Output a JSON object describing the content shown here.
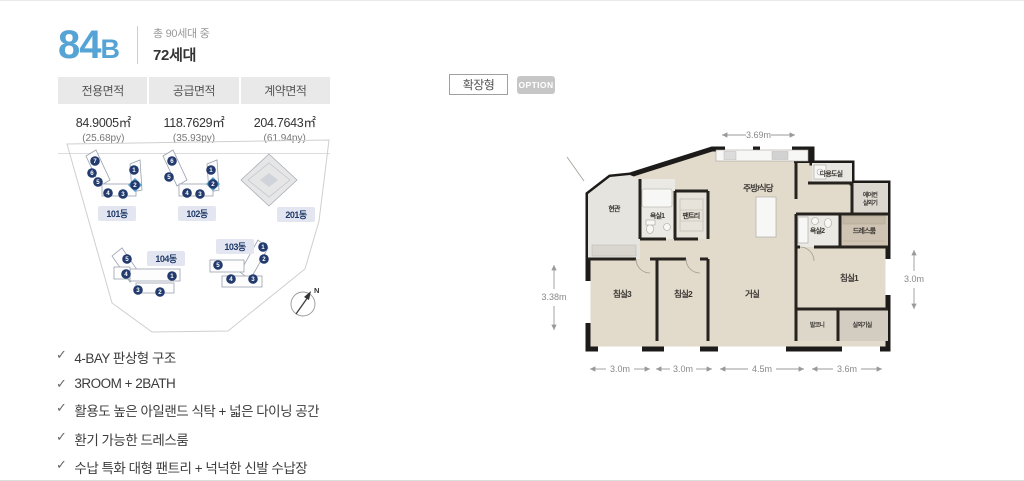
{
  "page": {
    "bg": "#ffffff",
    "border_color": "#e9e9e9"
  },
  "header": {
    "unit_number": "84",
    "unit_letter": "B",
    "accent_color": "#56a4d5",
    "total_text": "총 90세대 중",
    "count_text": "72세대"
  },
  "area_table": {
    "columns": [
      {
        "label": "전용면적",
        "area": "84.9005㎡",
        "py": "(25.68py)"
      },
      {
        "label": "공급면적",
        "area": "118.7629㎡",
        "py": "(35.93py)"
      },
      {
        "label": "계약면적",
        "area": "204.7643㎡",
        "py": "(61.94py)"
      }
    ]
  },
  "site_plan": {
    "buildings": [
      {
        "label": "101동",
        "units": [
          "1",
          "2",
          "3",
          "4",
          "5",
          "6",
          "7"
        ],
        "highlighted_unit": "2"
      },
      {
        "label": "102동",
        "units": [
          "1",
          "2",
          "3",
          "4",
          "5",
          "6"
        ],
        "highlighted_unit": "2"
      },
      {
        "label": "201동",
        "units": []
      },
      {
        "label": "104동",
        "units": [
          "1",
          "2",
          "3",
          "4",
          "5"
        ]
      },
      {
        "label": "103동",
        "units": [
          "1",
          "2",
          "3",
          "4",
          "5"
        ]
      }
    ],
    "compass": "N",
    "highlight_color": "#4f9dca",
    "marker_color": "#223a6d"
  },
  "features": {
    "check_icon": "✓",
    "items": [
      "4-BAY 판상형 구조",
      "3ROOM + 2BATH",
      "활용도 높은 아일랜드 식탁 + 넓은 다이닝 공간",
      "환기 가능한 드레스룸",
      "수납 특화 대형 팬트리 + 넉넉한 신발 수납장"
    ]
  },
  "plan_controls": {
    "type_button": "확장형",
    "option_button": "OPTION"
  },
  "floor_plan": {
    "rooms": {
      "entrance": "현관",
      "bath1": "욕실1",
      "pantry": "팬트리",
      "kitchen": "주방/식당",
      "utility": "다용도실",
      "ac_line1": "에어컨",
      "ac_line2": "실외기",
      "bath2": "욕실2",
      "dressroom": "드레스룸",
      "bed1": "침실1",
      "living": "거실",
      "bed2": "침실2",
      "bed3": "침실3",
      "balcony": "발코니",
      "outdoor_unit": "실외기실"
    },
    "dimensions": {
      "top": "3.69m",
      "left": "3.38m",
      "right": "3.0m",
      "bottom": [
        "3.0m",
        "3.0m",
        "4.5m",
        "3.6m"
      ]
    }
  }
}
